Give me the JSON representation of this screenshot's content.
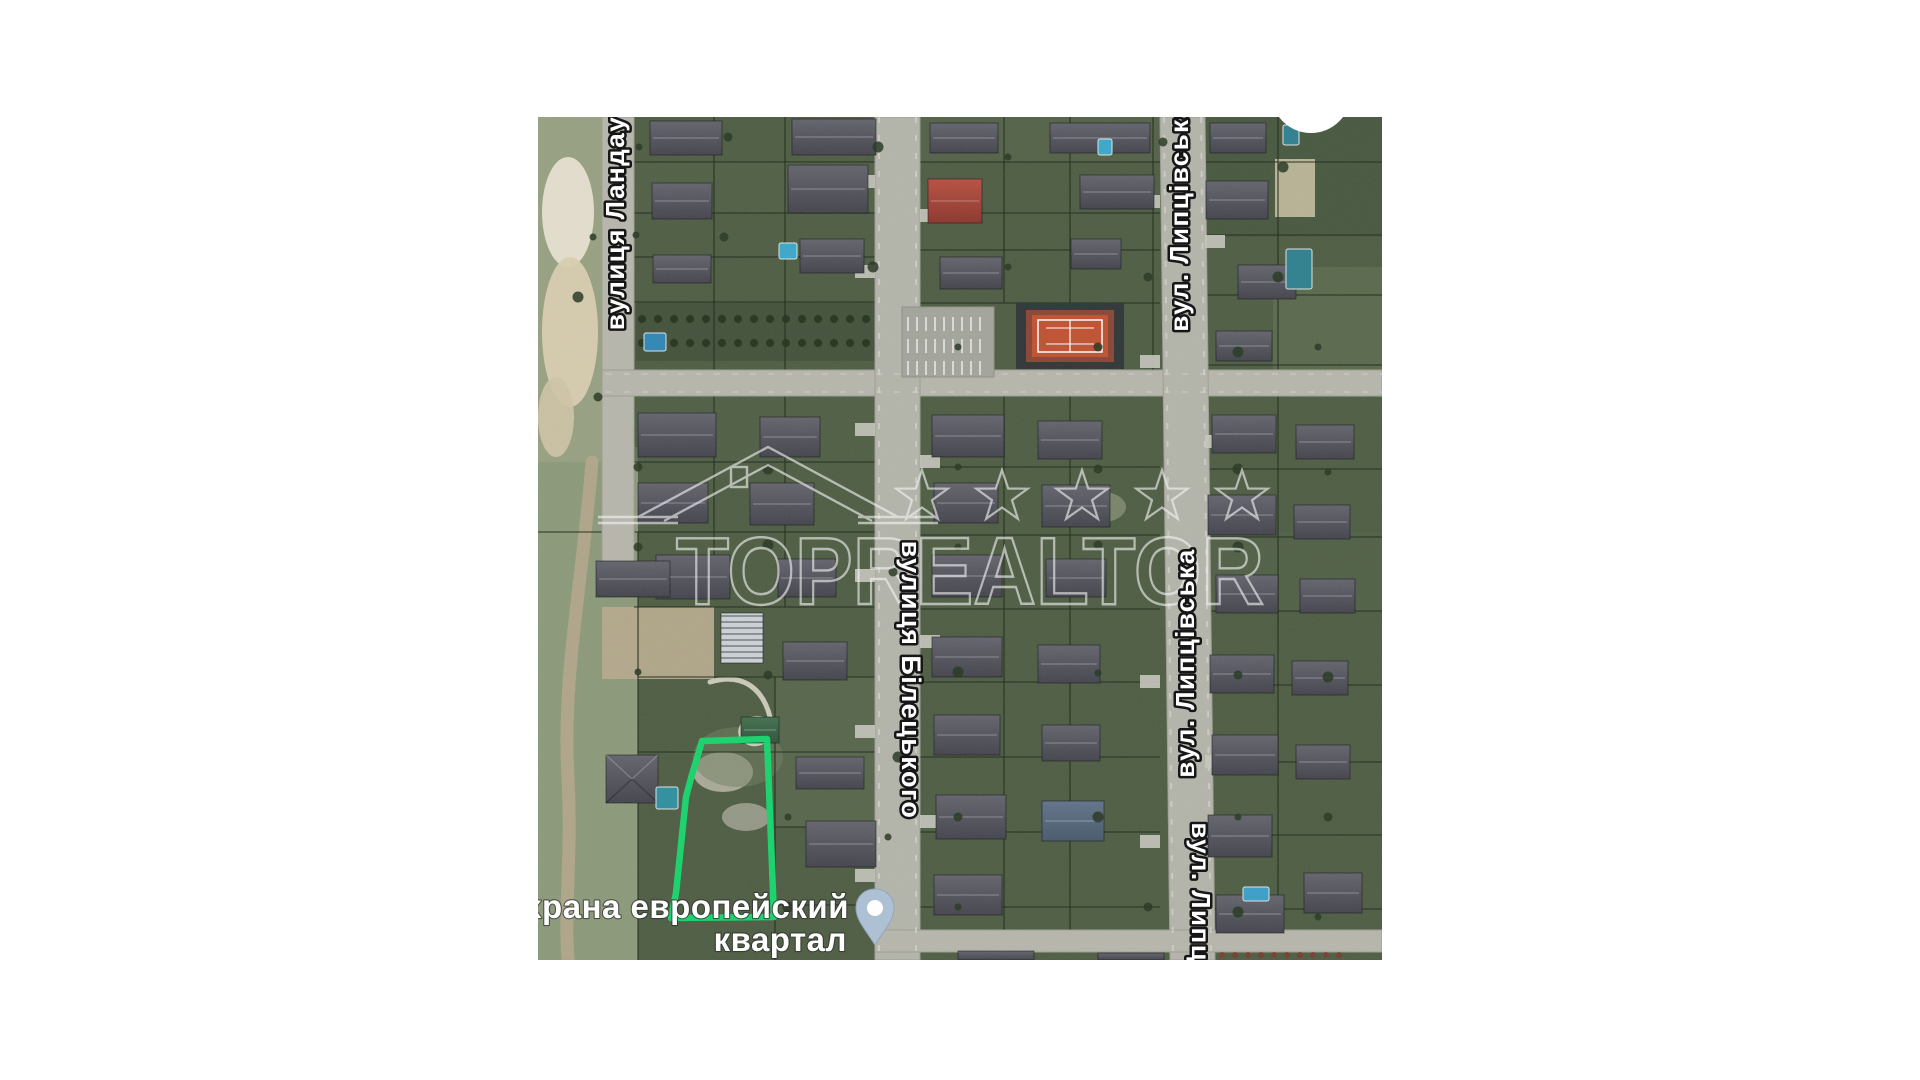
{
  "page": {
    "background": "#ffffff"
  },
  "map": {
    "left": 538,
    "top": 117,
    "width": 844,
    "height": 843
  },
  "labels": {
    "street_landau": "вулиця Ландау",
    "street_lyptsivska_top": "вул. Липцівська",
    "street_biletskoho": "вулиця Білецького",
    "street_lyptsivska_mid": "вул. Липцівська",
    "street_lyptsivska_bottom": "вул. Липцівська",
    "place_line1": "Охрана европейский",
    "place_line2": "квартал"
  },
  "watermark": {
    "text": "TOPREALTOR",
    "stars": 5,
    "color": "#f4f4f4",
    "opacity": 0.62
  },
  "plot_outline": {
    "color": "#1ed36f",
    "stroke_width": 6.5,
    "path": "M164,624 L229,622 L236,800 L133,801 L138,776 L148,680 L153,661 Z"
  },
  "pin": {
    "body_color": "#aec0d4",
    "dot_color": "#ffffff"
  },
  "colors": {
    "ground": "#4d5c42",
    "road": "#b6b6ac",
    "house_roof": "#55555f",
    "red_roof": "#a94437",
    "tennis_court": "#bf5130",
    "pool": "#2f86ad",
    "sand": "#d9ceb0",
    "white_circle": "#ffffff"
  },
  "map_features": {
    "roads": [
      {
        "type": "rect",
        "x": 64,
        "y": 0,
        "w": 32,
        "h": 478,
        "fill": "#b6b6ac"
      },
      {
        "type": "rect",
        "x": 64,
        "y": 253,
        "w": 780,
        "h": 26,
        "fill": "#b6b6ac"
      },
      {
        "type": "rect",
        "x": 337,
        "y": 0,
        "w": 45,
        "h": 843,
        "fill": "#b3b4aa"
      },
      {
        "type": "poly",
        "pts": "622,0 667,0 677,843 632,843",
        "fill": "#b3b4aa"
      },
      {
        "type": "rect",
        "x": 337,
        "y": 813,
        "w": 507,
        "h": 22,
        "fill": "#b6b6ac"
      }
    ],
    "patches": [
      {
        "type": "rect",
        "x": 0,
        "y": 330,
        "w": 100,
        "h": 513,
        "fill": "#8e9c7c",
        "op": 0.95
      },
      {
        "type": "rect",
        "x": 0,
        "y": 0,
        "w": 66,
        "h": 345,
        "fill": "#97a081",
        "op": 1
      },
      {
        "type": "ellipse",
        "cx": 30,
        "cy": 95,
        "rx": 26,
        "ry": 55,
        "fill": "#e7e1d0",
        "op": 0.95
      },
      {
        "type": "ellipse",
        "cx": 32,
        "cy": 215,
        "rx": 28,
        "ry": 75,
        "fill": "#d9ceb0",
        "op": 0.95
      },
      {
        "type": "ellipse",
        "cx": 18,
        "cy": 300,
        "rx": 18,
        "ry": 40,
        "fill": "#cfc4a6",
        "op": 0.9
      },
      {
        "type": "rect",
        "x": 98,
        "y": 186,
        "w": 239,
        "h": 58,
        "fill": "#42513a",
        "op": 1
      },
      {
        "type": "rect",
        "x": 667,
        "y": 0,
        "w": 177,
        "h": 120,
        "fill": "#44543c",
        "op": 0.6
      },
      {
        "type": "rect",
        "x": 735,
        "y": 150,
        "w": 109,
        "h": 130,
        "fill": "#5d6b4e",
        "op": 0.8
      },
      {
        "type": "rect",
        "x": 64,
        "y": 490,
        "w": 112,
        "h": 72,
        "fill": "#b5a98c",
        "op": 0.95
      },
      {
        "type": "rect",
        "x": 737,
        "y": 42,
        "w": 40,
        "h": 58,
        "fill": "#cdc3a4",
        "op": 0.85
      },
      {
        "type": "ellipse",
        "cx": 185,
        "cy": 655,
        "rx": 30,
        "ry": 20,
        "fill": "#cfcabc",
        "op": 0.7
      },
      {
        "type": "ellipse",
        "cx": 208,
        "cy": 700,
        "rx": 24,
        "ry": 14,
        "fill": "#c5c0b2",
        "op": 0.6
      },
      {
        "type": "rect",
        "x": 382,
        "y": 0,
        "w": 240,
        "h": 45,
        "fill": "#55644a",
        "op": 0.7
      },
      {
        "type": "rect",
        "x": 96,
        "y": 45,
        "w": 241,
        "h": 51,
        "fill": "#526146",
        "op": 0.6
      },
      {
        "type": "rect",
        "x": 96,
        "y": 279,
        "w": 241,
        "h": 66,
        "fill": "#4f5f44",
        "op": 0.7
      },
      {
        "type": "rect",
        "x": 667,
        "y": 415,
        "w": 177,
        "h": 79,
        "fill": "#526148",
        "op": 0.6
      },
      {
        "type": "rect",
        "x": 237,
        "y": 560,
        "w": 100,
        "h": 150,
        "fill": "#5d6b50",
        "op": 0.6
      },
      {
        "type": "ellipse",
        "cx": 200,
        "cy": 640,
        "rx": 45,
        "ry": 30,
        "fill": "#6f7d5f",
        "op": 0.5
      },
      {
        "type": "ellipse",
        "cx": 560,
        "cy": 390,
        "rx": 28,
        "ry": 16,
        "fill": "#8a9579",
        "op": 0.7
      }
    ],
    "dirt_paths": [
      {
        "d": "M54,345 C44,470 24,560 30,660 C34,740 26,790 30,843",
        "w": 13,
        "c": "#b3a68b",
        "op": 0.9
      },
      {
        "d": "M172,565 C205,555 225,572 232,600 C238,622 220,632 208,624 C196,616 206,598 224,602",
        "w": 5,
        "c": "#d9d5c5",
        "op": 0.9
      }
    ],
    "fences_v": [
      {
        "x": 176,
        "y1": 0,
        "y2": 253
      },
      {
        "x": 247,
        "y1": 0,
        "y2": 253
      },
      {
        "x": 466,
        "y1": 0,
        "y2": 186
      },
      {
        "x": 532,
        "y1": 0,
        "y2": 186
      },
      {
        "x": 740,
        "y1": 0,
        "y2": 253
      },
      {
        "x": 615,
        "y1": 0,
        "y2": 253
      },
      {
        "x": 100,
        "y1": 415,
        "y2": 843
      },
      {
        "x": 176,
        "y1": 279,
        "y2": 470
      },
      {
        "x": 247,
        "y1": 279,
        "y2": 490
      },
      {
        "x": 466,
        "y1": 279,
        "y2": 813
      },
      {
        "x": 532,
        "y1": 279,
        "y2": 813
      },
      {
        "x": 740,
        "y1": 279,
        "y2": 813
      },
      {
        "x": 237,
        "y1": 560,
        "y2": 843
      }
    ],
    "fences_h": [
      {
        "y": 45,
        "x1": 96,
        "x2": 337
      },
      {
        "y": 45,
        "x1": 382,
        "x2": 622
      },
      {
        "y": 45,
        "x1": 667,
        "x2": 844
      },
      {
        "y": 96,
        "x1": 96,
        "x2": 337
      },
      {
        "y": 96,
        "x1": 382,
        "x2": 622
      },
      {
        "y": 118,
        "x1": 667,
        "x2": 844
      },
      {
        "y": 140,
        "x1": 96,
        "x2": 337
      },
      {
        "y": 133,
        "x1": 382,
        "x2": 622
      },
      {
        "y": 178,
        "x1": 667,
        "x2": 844
      },
      {
        "y": 185,
        "x1": 96,
        "x2": 337
      },
      {
        "y": 186,
        "x1": 382,
        "x2": 622
      },
      {
        "y": 248,
        "x1": 667,
        "x2": 844
      },
      {
        "y": 345,
        "x1": 96,
        "x2": 337
      },
      {
        "y": 350,
        "x1": 382,
        "x2": 622
      },
      {
        "y": 352,
        "x1": 667,
        "x2": 844
      },
      {
        "y": 415,
        "x1": 0,
        "x2": 337
      },
      {
        "y": 418,
        "x1": 382,
        "x2": 622
      },
      {
        "y": 420,
        "x1": 667,
        "x2": 844
      },
      {
        "y": 490,
        "x1": 96,
        "x2": 337
      },
      {
        "y": 492,
        "x1": 382,
        "x2": 622
      },
      {
        "y": 494,
        "x1": 667,
        "x2": 844
      },
      {
        "y": 560,
        "x1": 100,
        "x2": 337
      },
      {
        "y": 565,
        "x1": 382,
        "x2": 622
      },
      {
        "y": 568,
        "x1": 667,
        "x2": 844
      },
      {
        "y": 635,
        "x1": 100,
        "x2": 337
      },
      {
        "y": 640,
        "x1": 382,
        "x2": 622
      },
      {
        "y": 645,
        "x1": 667,
        "x2": 844
      },
      {
        "y": 710,
        "x1": 237,
        "x2": 337
      },
      {
        "y": 715,
        "x1": 382,
        "x2": 622
      },
      {
        "y": 718,
        "x1": 667,
        "x2": 844
      },
      {
        "y": 788,
        "x1": 237,
        "x2": 337
      },
      {
        "y": 790,
        "x1": 382,
        "x2": 622
      },
      {
        "y": 792,
        "x1": 667,
        "x2": 844
      }
    ],
    "houses": [
      {
        "x": 112,
        "y": 4,
        "w": 72,
        "h": 34
      },
      {
        "x": 254,
        "y": 2,
        "w": 84,
        "h": 36
      },
      {
        "x": 114,
        "y": 66,
        "w": 60,
        "h": 36
      },
      {
        "x": 250,
        "y": 48,
        "w": 80,
        "h": 48
      },
      {
        "x": 115,
        "y": 138,
        "w": 58,
        "h": 28
      },
      {
        "x": 262,
        "y": 122,
        "w": 64,
        "h": 34
      },
      {
        "x": 392,
        "y": 6,
        "w": 68,
        "h": 30
      },
      {
        "x": 512,
        "y": 6,
        "w": 100,
        "h": 30
      },
      {
        "x": 390,
        "y": 62,
        "w": 54,
        "h": 44,
        "roof": "red"
      },
      {
        "x": 542,
        "y": 58,
        "w": 74,
        "h": 34
      },
      {
        "x": 402,
        "y": 140,
        "w": 62,
        "h": 32
      },
      {
        "x": 533,
        "y": 122,
        "w": 50,
        "h": 30
      },
      {
        "x": 672,
        "y": 6,
        "w": 56,
        "h": 30
      },
      {
        "x": 668,
        "y": 64,
        "w": 62,
        "h": 38
      },
      {
        "x": 700,
        "y": 148,
        "w": 58,
        "h": 34
      },
      {
        "x": 678,
        "y": 214,
        "w": 56,
        "h": 30
      },
      {
        "x": 100,
        "y": 296,
        "w": 78,
        "h": 44
      },
      {
        "x": 222,
        "y": 300,
        "w": 60,
        "h": 40
      },
      {
        "x": 100,
        "y": 366,
        "w": 70,
        "h": 40
      },
      {
        "x": 212,
        "y": 366,
        "w": 64,
        "h": 42
      },
      {
        "x": 118,
        "y": 438,
        "w": 74,
        "h": 44
      },
      {
        "x": 240,
        "y": 442,
        "w": 58,
        "h": 38
      },
      {
        "x": 394,
        "y": 298,
        "w": 72,
        "h": 42
      },
      {
        "x": 500,
        "y": 304,
        "w": 64,
        "h": 38
      },
      {
        "x": 396,
        "y": 366,
        "w": 64,
        "h": 40
      },
      {
        "x": 504,
        "y": 368,
        "w": 68,
        "h": 42
      },
      {
        "x": 394,
        "y": 438,
        "w": 70,
        "h": 42
      },
      {
        "x": 508,
        "y": 442,
        "w": 60,
        "h": 38
      },
      {
        "x": 674,
        "y": 298,
        "w": 64,
        "h": 38
      },
      {
        "x": 758,
        "y": 308,
        "w": 58,
        "h": 34
      },
      {
        "x": 670,
        "y": 378,
        "w": 68,
        "h": 40
      },
      {
        "x": 756,
        "y": 388,
        "w": 56,
        "h": 34
      },
      {
        "x": 678,
        "y": 458,
        "w": 62,
        "h": 38
      },
      {
        "x": 762,
        "y": 462,
        "w": 55,
        "h": 34
      },
      {
        "x": 58,
        "y": 444,
        "w": 74,
        "h": 36
      },
      {
        "x": 245,
        "y": 525,
        "w": 64,
        "h": 38
      },
      {
        "x": 183,
        "y": 496,
        "w": 42,
        "h": 50,
        "roof": "striped"
      },
      {
        "x": 203,
        "y": 600,
        "w": 38,
        "h": 26,
        "roof": "green"
      },
      {
        "x": 68,
        "y": 638,
        "w": 52,
        "h": 48,
        "roof": "hip"
      },
      {
        "x": 258,
        "y": 640,
        "w": 68,
        "h": 32
      },
      {
        "x": 268,
        "y": 704,
        "w": 70,
        "h": 46
      },
      {
        "x": 394,
        "y": 520,
        "w": 70,
        "h": 40
      },
      {
        "x": 500,
        "y": 528,
        "w": 62,
        "h": 38
      },
      {
        "x": 396,
        "y": 598,
        "w": 66,
        "h": 40
      },
      {
        "x": 504,
        "y": 608,
        "w": 58,
        "h": 36
      },
      {
        "x": 398,
        "y": 678,
        "w": 70,
        "h": 44
      },
      {
        "x": 504,
        "y": 684,
        "w": 62,
        "h": 40,
        "roof": "blue"
      },
      {
        "x": 396,
        "y": 758,
        "w": 68,
        "h": 40
      },
      {
        "x": 672,
        "y": 538,
        "w": 64,
        "h": 38
      },
      {
        "x": 754,
        "y": 544,
        "w": 56,
        "h": 34
      },
      {
        "x": 674,
        "y": 618,
        "w": 66,
        "h": 40
      },
      {
        "x": 758,
        "y": 628,
        "w": 54,
        "h": 34
      },
      {
        "x": 670,
        "y": 698,
        "w": 64,
        "h": 42
      },
      {
        "x": 678,
        "y": 778,
        "w": 68,
        "h": 38
      },
      {
        "x": 766,
        "y": 756,
        "w": 58,
        "h": 40
      },
      {
        "x": 420,
        "y": 834,
        "w": 76,
        "h": 9
      },
      {
        "x": 560,
        "y": 836,
        "w": 66,
        "h": 7
      }
    ],
    "pools": [
      {
        "x": 241,
        "y": 126,
        "w": 18,
        "h": 16,
        "c": "#3aa7c9"
      },
      {
        "x": 106,
        "y": 216,
        "w": 22,
        "h": 18,
        "c": "#2e86b5"
      },
      {
        "x": 748,
        "y": 132,
        "w": 26,
        "h": 40,
        "c": "#2e7f8f"
      },
      {
        "x": 118,
        "y": 670,
        "w": 22,
        "h": 22,
        "c": "#2e8f9f"
      },
      {
        "x": 705,
        "y": 770,
        "w": 26,
        "h": 14,
        "c": "#3a9ec9"
      },
      {
        "x": 560,
        "y": 22,
        "w": 14,
        "h": 16,
        "c": "#3aa7c9"
      },
      {
        "x": 745,
        "y": 8,
        "w": 16,
        "h": 20,
        "c": "#2e7f8f"
      }
    ],
    "driveways": [
      [
        317,
        58
      ],
      [
        317,
        148
      ],
      [
        317,
        306
      ],
      [
        317,
        452
      ],
      [
        317,
        608
      ],
      [
        317,
        752
      ],
      [
        382,
        92
      ],
      [
        382,
        208
      ],
      [
        382,
        338
      ],
      [
        382,
        518
      ],
      [
        382,
        698
      ],
      [
        602,
        78
      ],
      [
        602,
        238
      ],
      [
        602,
        558
      ],
      [
        602,
        718
      ],
      [
        667,
        118
      ],
      [
        667,
        318
      ],
      [
        667,
        638
      ]
    ],
    "trees": [
      [
        101,
        30
      ],
      [
        190,
        20
      ],
      [
        340,
        30
      ],
      [
        470,
        40
      ],
      [
        625,
        25
      ],
      [
        745,
        50
      ],
      [
        98,
        118
      ],
      [
        186,
        120
      ],
      [
        335,
        150
      ],
      [
        470,
        150
      ],
      [
        610,
        160
      ],
      [
        740,
        160
      ],
      [
        420,
        230
      ],
      [
        560,
        230
      ],
      [
        700,
        235
      ],
      [
        780,
        230
      ],
      [
        100,
        350
      ],
      [
        230,
        352
      ],
      [
        420,
        350
      ],
      [
        560,
        352
      ],
      [
        700,
        352
      ],
      [
        790,
        355
      ],
      [
        100,
        430
      ],
      [
        230,
        428
      ],
      [
        420,
        430
      ],
      [
        560,
        428
      ],
      [
        700,
        430
      ],
      [
        100,
        555
      ],
      [
        230,
        558
      ],
      [
        420,
        555
      ],
      [
        560,
        556
      ],
      [
        700,
        558
      ],
      [
        790,
        560
      ],
      [
        250,
        700
      ],
      [
        420,
        700
      ],
      [
        560,
        700
      ],
      [
        700,
        700
      ],
      [
        790,
        700
      ],
      [
        250,
        790
      ],
      [
        420,
        790
      ],
      [
        610,
        790
      ],
      [
        700,
        795
      ],
      [
        780,
        800
      ],
      [
        60,
        280
      ],
      [
        40,
        180
      ],
      [
        55,
        120
      ],
      [
        355,
        455
      ],
      [
        360,
        640
      ],
      [
        350,
        720
      ]
    ],
    "red_shrubs_y": 838,
    "red_shrubs_x": [
      684,
      697,
      710,
      723,
      736,
      749,
      762,
      775,
      788,
      801
    ],
    "tennis": {
      "surround": {
        "x": 478,
        "y": 186,
        "w": 108,
        "h": 66
      },
      "frame": {
        "x": 488,
        "y": 193,
        "w": 88,
        "h": 52
      },
      "court": {
        "x": 494,
        "y": 198,
        "w": 76,
        "h": 42
      },
      "lines": {
        "x": 500,
        "y": 203,
        "w": 64,
        "h": 32
      }
    },
    "parking": {
      "x": 364,
      "y": 190,
      "w": 92,
      "h": 70
    },
    "white_circle": {
      "cx": 773,
      "cy": -24,
      "r": 40
    }
  }
}
